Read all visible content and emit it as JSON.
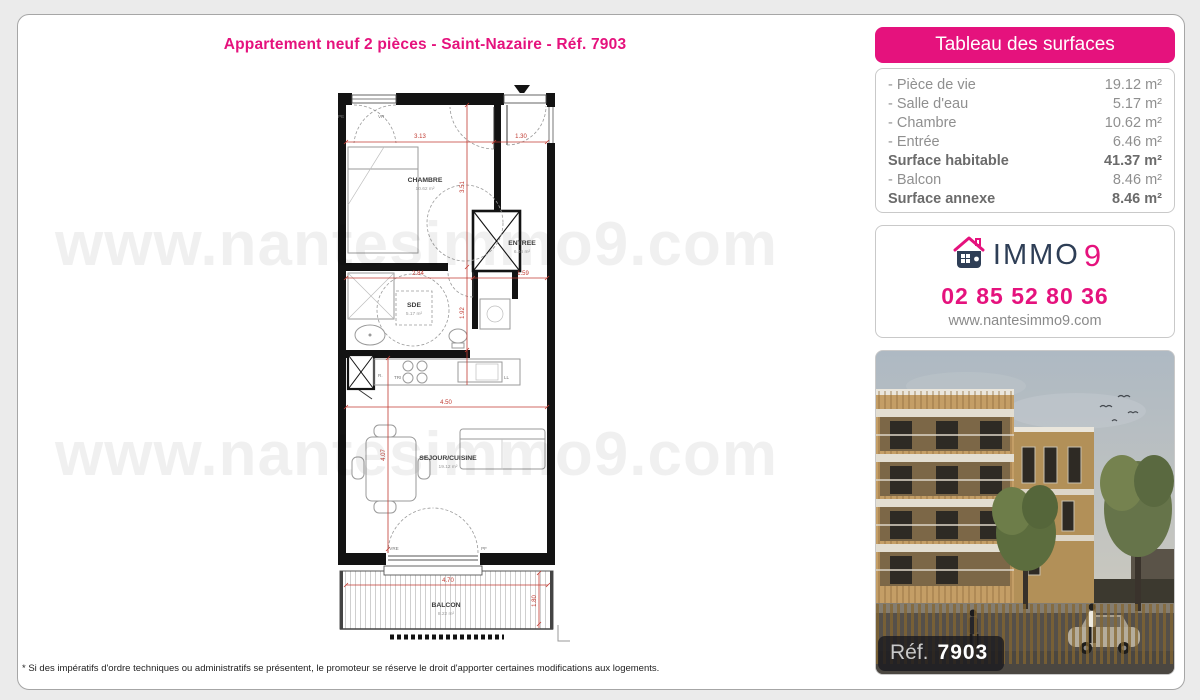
{
  "page": {
    "title": "Appartement neuf 2 pièces - Saint-Nazaire - Réf. 7903",
    "watermark": "www.nantesimmo9.com",
    "footnote": "* Si des impératifs d'ordre techniques ou administratifs se présentent, le promoteur se réserve le droit d'apporter certaines modifications aux logements."
  },
  "surfaces_table": {
    "header": "Tableau des surfaces",
    "rows": [
      {
        "label": "- Pièce de vie",
        "value": "19.12 m²"
      },
      {
        "label": "- Salle d'eau",
        "value": "5.17 m²"
      },
      {
        "label": "- Chambre",
        "value": "10.62 m²"
      },
      {
        "label": "- Entrée",
        "value": "6.46 m²"
      },
      {
        "label": "Surface habitable",
        "value": "41.37 m²"
      },
      {
        "label": "- Balcon",
        "value": "8.46 m²"
      },
      {
        "label": "Surface annexe",
        "value": "8.46 m²"
      }
    ]
  },
  "contact": {
    "brand_immo": "IMMO",
    "brand_9": "9",
    "phone": "02 85 52 80 36",
    "website": "www.nantesimmo9.com"
  },
  "photo": {
    "ref_label": "Réf.",
    "ref_number": "7903"
  },
  "plan": {
    "rooms": [
      {
        "name": "CHAMBRE",
        "area": "10.62 m²"
      },
      {
        "name": "ENTREE",
        "area": "6.46 m²"
      },
      {
        "name": "SDE",
        "area": "5.17 m²"
      },
      {
        "name": "SEJOUR/CUISINE",
        "area": "19.12 m²"
      },
      {
        "name": "BALCON",
        "area": "8.22 m²"
      }
    ],
    "dimensions": [
      "3.13",
      "1.30",
      "3.51",
      "2.84",
      "1.59",
      "1.92",
      "4.50",
      "4.07",
      "4.70",
      "1.80"
    ],
    "annotations": [
      "PE",
      "VR",
      "VRE",
      "PF",
      "R.",
      "TRI",
      "LL"
    ]
  },
  "colors": {
    "accent_pink": "#e5127d",
    "navy": "#2e3e56",
    "dimension_red": "#c03a31",
    "page_background": "#ebebeb"
  }
}
